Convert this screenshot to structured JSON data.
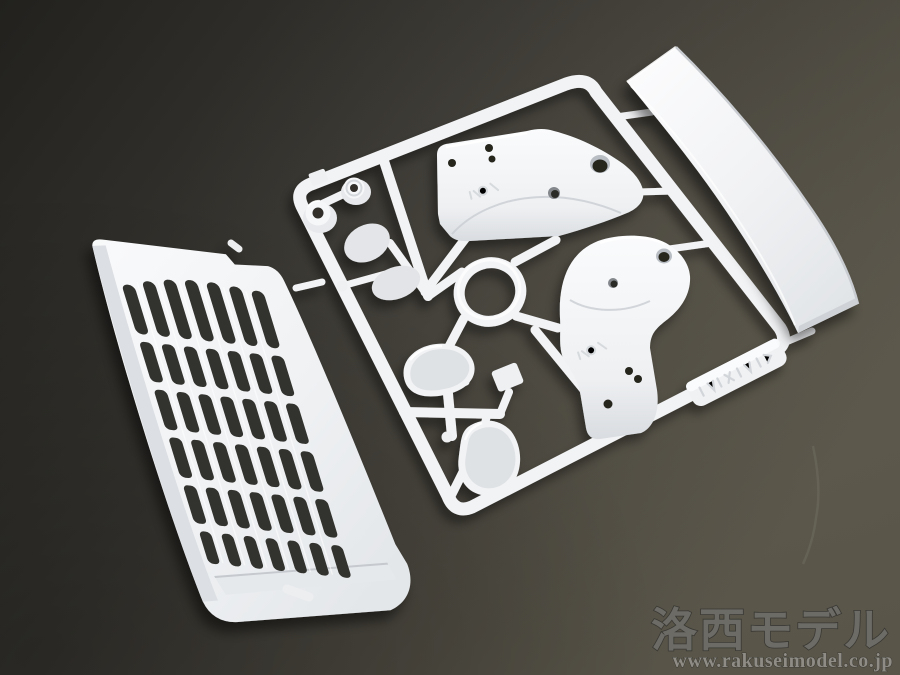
{
  "watermark": {
    "brand_text": "洛西モデル",
    "url_text": "www.rakuseimodel.co.jp"
  },
  "colors": {
    "background_dark": "#22211e",
    "background_mid": "#393732",
    "background_light": "#595549",
    "plastic_white": "#f3f4f6",
    "plastic_bright": "#fbfcfd",
    "plastic_shade": "#d3d6da",
    "plastic_dark_shade": "#c2c6cb",
    "slot_dark": "#33322e",
    "hole_dark": "#26251f",
    "watermark_text": "#6f6e68",
    "watermark_outline": "#393833",
    "watermark_url": "#8e8c84"
  }
}
